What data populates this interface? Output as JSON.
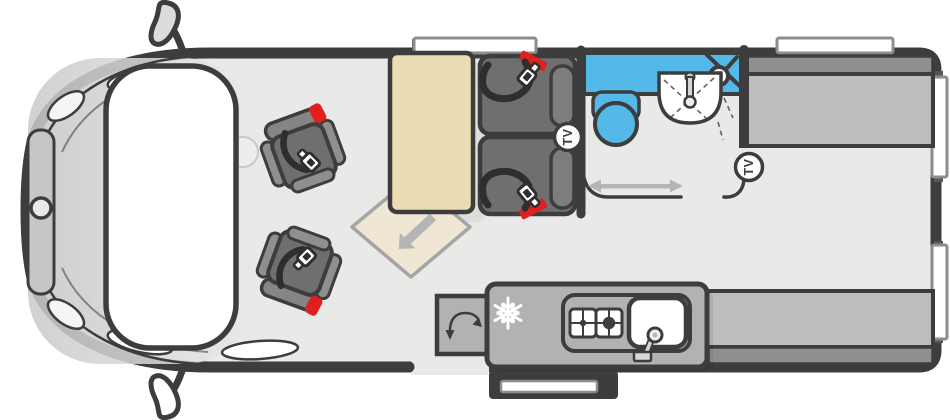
{
  "diagram": {
    "type": "campervan-floorplan-top-view",
    "labels": {
      "tv_front": "TV",
      "tv_rear": "TV"
    },
    "palette": {
      "outline": "#3d3d3d",
      "floor": "#e9e9e8",
      "cab_gray": "#c9c9c9",
      "white": "#ffffff",
      "table_tan": "#ecdcb4",
      "extension_tan": "#efe7d3",
      "extension_border": "#a5a5a5",
      "seat_dark": "#6f6f6f",
      "seat_mid": "#7d7d7d",
      "seat_light": "#8f8f8f",
      "belt_dark": "#2e2e2e",
      "accent_red": "#e01f1f",
      "wet_blue": "#54b8e8",
      "furniture_gray": "#bdbdbd",
      "furniture_dark": "#8f8f8f",
      "kitchen_gray": "#b2b2b2",
      "arrow_gray": "#b5b5b5",
      "window_frame": "#8d8d8d"
    },
    "zones": {
      "cab": {
        "features": [
          "windshield",
          "bonnet-grille",
          "badge",
          "headlights",
          "wing-mirror-top",
          "wing-mirror-bottom",
          "steering-wheel",
          "swivel-seat-upper",
          "swivel-seat-lower"
        ]
      },
      "front_lounge": {
        "features": [
          "table",
          "table-extension-leaf",
          "extension-arrow",
          "travel-seat-upper",
          "travel-seat-lower",
          "tv-point-front",
          "window-front"
        ]
      },
      "washroom": {
        "features": [
          "shower-tray",
          "shower-head",
          "toilet",
          "folding-basin",
          "sliding-door-track",
          "sliding-door-arrow"
        ]
      },
      "kitchen": {
        "features": [
          "fridge-snowflake",
          "two-burner-hob",
          "sink-with-tap",
          "entry-door-swing",
          "sliding-habitation-door"
        ]
      },
      "rear_lounge": {
        "features": [
          "bench-top",
          "bench-bottom",
          "tv-point-rear",
          "window-rear-top",
          "rear-door-windows"
        ]
      }
    }
  }
}
